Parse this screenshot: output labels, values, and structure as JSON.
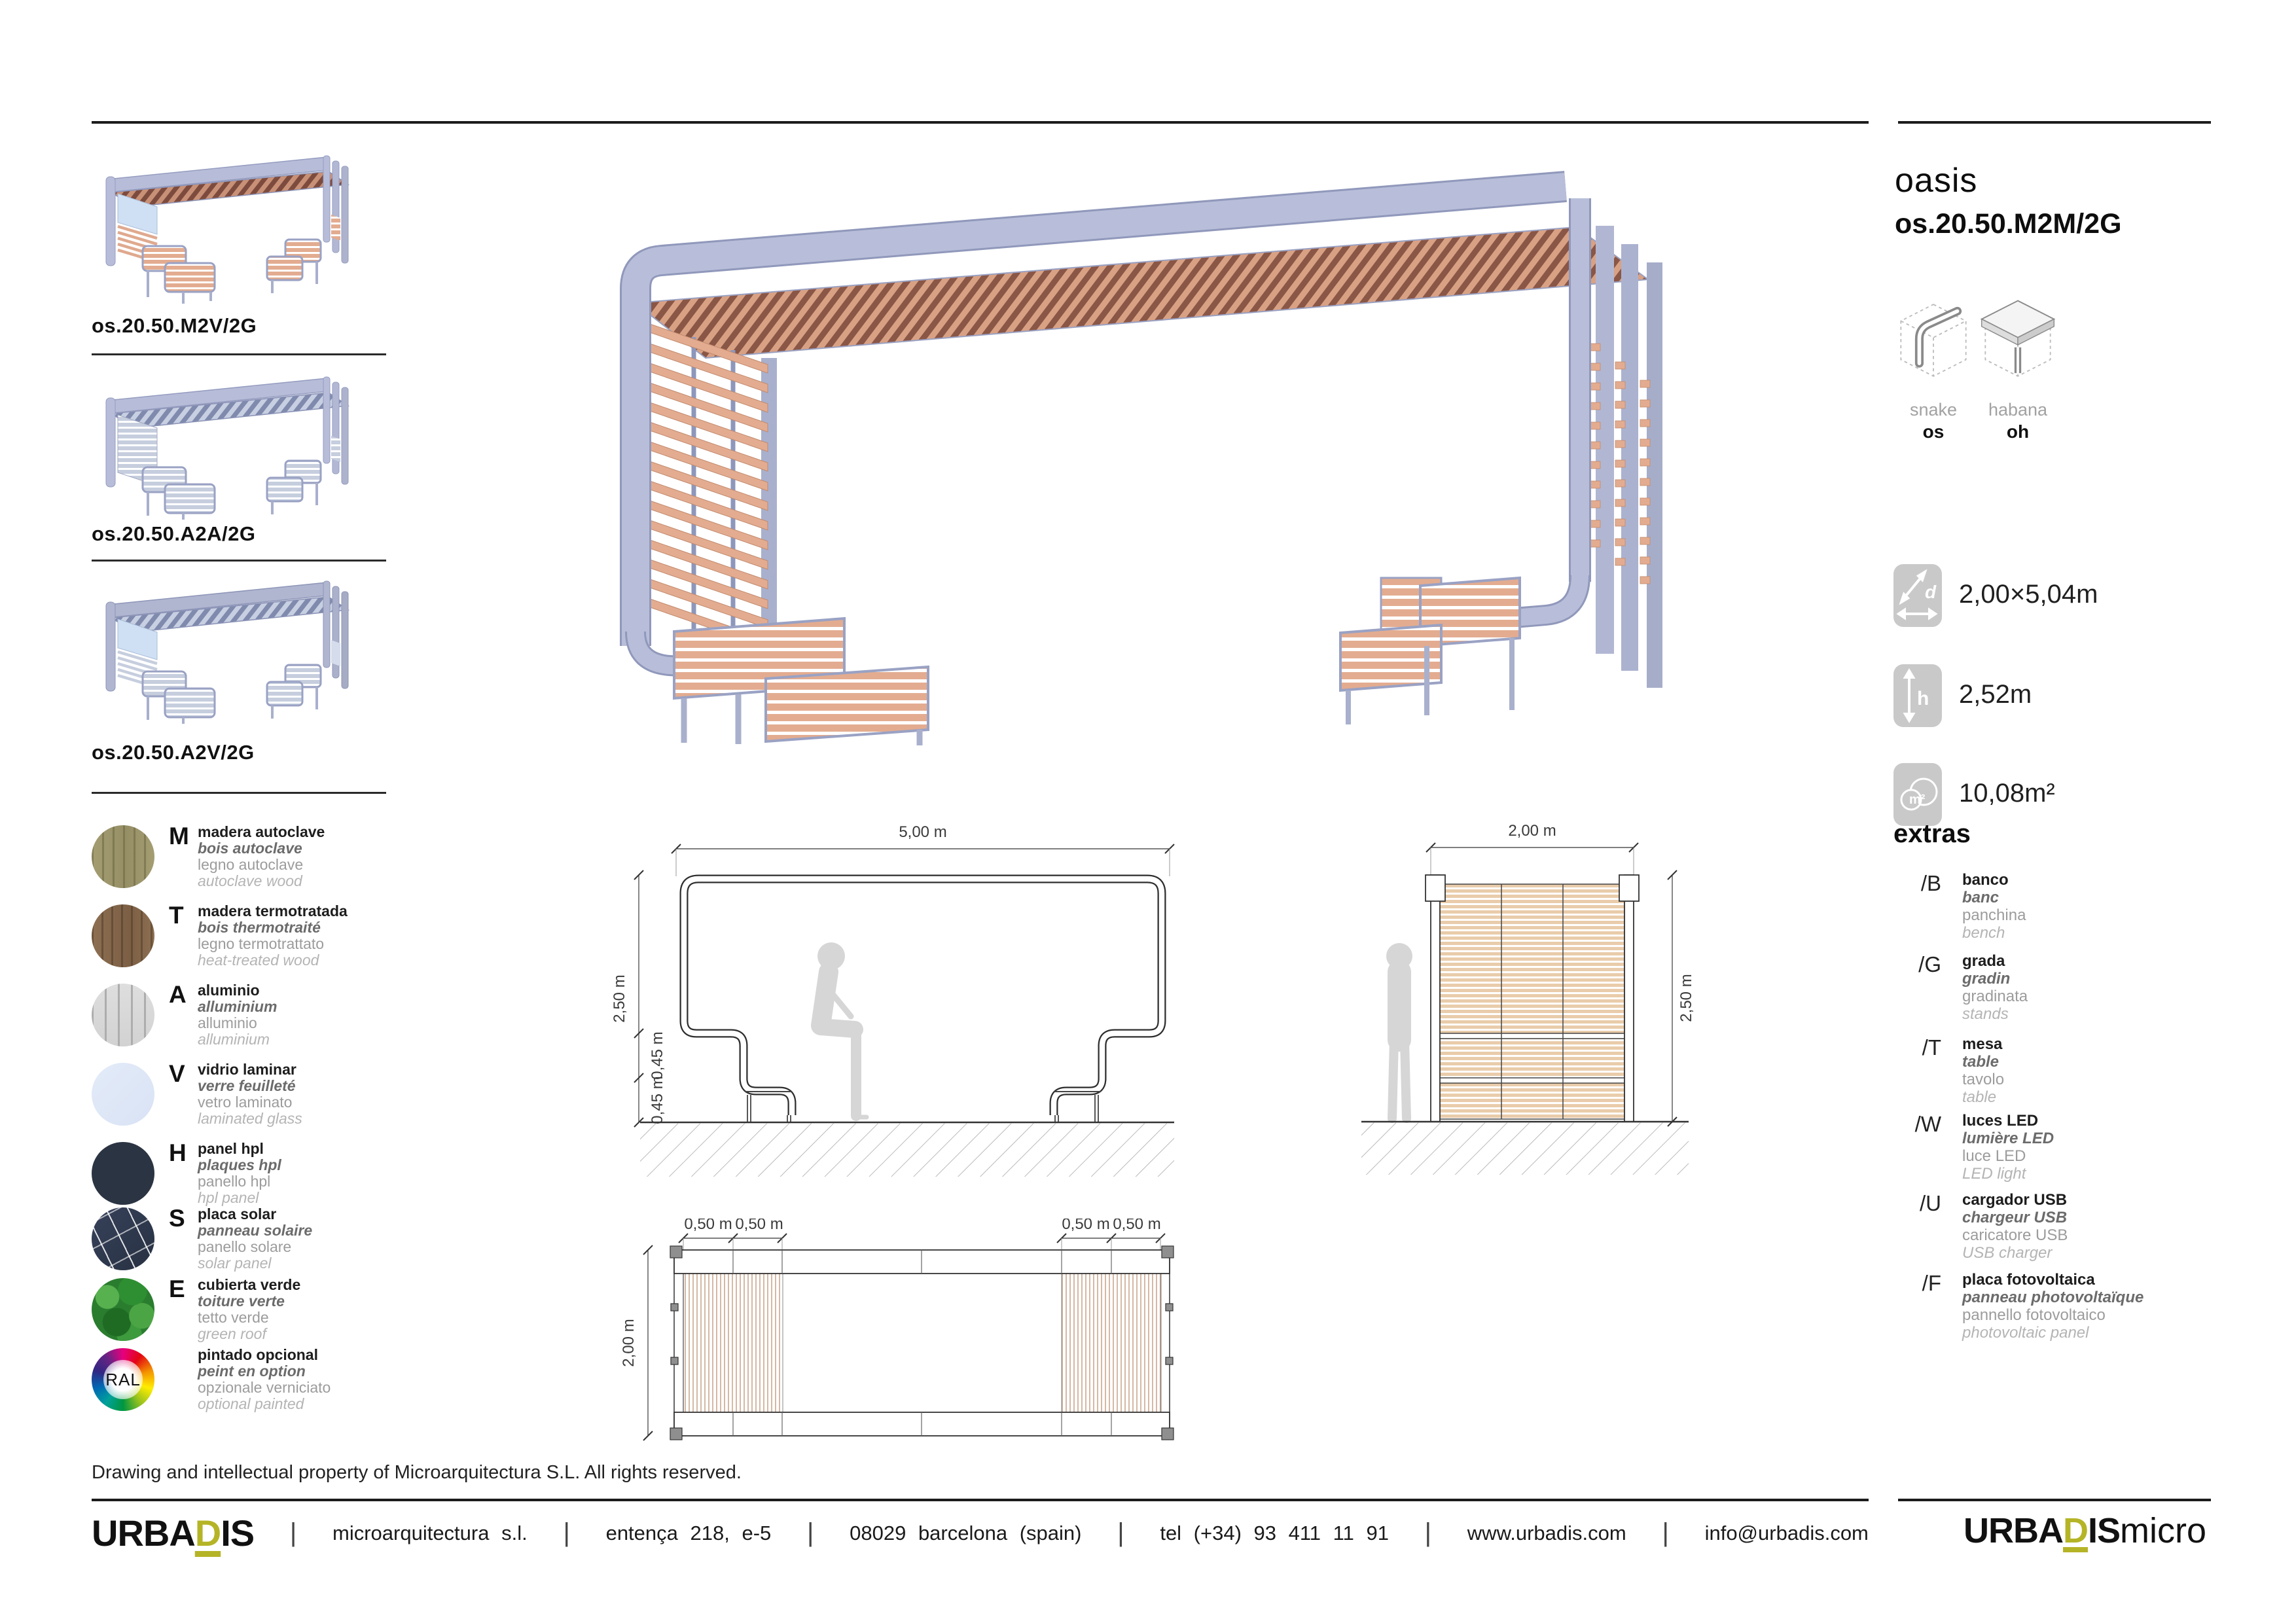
{
  "header": {
    "title": "oasis",
    "model": "os.20.50.M2M/2G",
    "families": [
      {
        "name": "snake",
        "code": "os"
      },
      {
        "name": "habana",
        "code": "oh"
      }
    ]
  },
  "specs": [
    {
      "name": "footprint",
      "value": "2,00×5,04m"
    },
    {
      "name": "height",
      "value": "2,52m"
    },
    {
      "name": "area",
      "value": "10,08m²"
    }
  ],
  "variants": [
    {
      "code": "os.20.50.M2V/2G"
    },
    {
      "code": "os.20.50.A2A/2G"
    },
    {
      "code": "os.20.50.A2V/2G"
    }
  ],
  "materials": {
    "ral_label": "RAL",
    "items": [
      {
        "letter": "M",
        "lines": [
          "madera autoclave",
          "bois autoclave",
          "legno autoclave",
          "autoclave wood"
        ]
      },
      {
        "letter": "T",
        "lines": [
          "madera termotratada",
          "bois thermotraité",
          "legno termotrattato",
          "heat-treated wood"
        ]
      },
      {
        "letter": "A",
        "lines": [
          "aluminio",
          "alluminium",
          "alluminio",
          "alluminium"
        ]
      },
      {
        "letter": "V",
        "lines": [
          "vidrio laminar",
          "verre feuilleté",
          "vetro laminato",
          "laminated glass"
        ]
      },
      {
        "letter": "H",
        "lines": [
          "panel hpl",
          "plaques hpl",
          "panello hpl",
          "hpl panel"
        ]
      },
      {
        "letter": "S",
        "lines": [
          "placa solar",
          "panneau solaire",
          "panello solare",
          "solar panel"
        ]
      },
      {
        "letter": "E",
        "lines": [
          "cubierta verde",
          "toiture verte",
          "tetto verde",
          "green roof"
        ]
      },
      {
        "letter": "",
        "lines": [
          "pintado opcional",
          "peint en option",
          "opzionale verniciato",
          "optional painted"
        ]
      }
    ]
  },
  "extras": {
    "heading": "extras",
    "items": [
      {
        "code": "/B",
        "lines": [
          "banco",
          "banc",
          "panchina",
          "bench"
        ]
      },
      {
        "code": "/G",
        "lines": [
          "grada",
          "gradin",
          "gradinata",
          "stands"
        ]
      },
      {
        "code": "/T",
        "lines": [
          "mesa",
          "table",
          "tavolo",
          "table"
        ]
      },
      {
        "code": "/W",
        "lines": [
          "luces LED",
          "lumière LED",
          "luce LED",
          "LED light"
        ]
      },
      {
        "code": "/U",
        "lines": [
          "cargador USB",
          "chargeur USB",
          "caricatore USB",
          "USB charger"
        ]
      },
      {
        "code": "/F",
        "lines": [
          "placa fotovoltaica",
          "panneau photovoltaïque",
          "pannello fotovoltaico",
          "photovoltaic panel"
        ]
      }
    ]
  },
  "drawings": {
    "front": {
      "width": "5,00 m",
      "height": "2,50 m",
      "step1": "0,45 m",
      "step2": "0,45 m"
    },
    "side": {
      "width": "2,00 m",
      "height": "2,50 m"
    },
    "plan": {
      "depth": "2,00 m",
      "mod1": "0,50 m",
      "mod2": "0,50 m",
      "mod3": "0,50 m",
      "mod4": "0,50 m"
    }
  },
  "footer": {
    "copyright": "Drawing and intellectual property of Microarquitectura S.L. All rights reserved.",
    "brand": {
      "pre": "URBA",
      "d": "D",
      "post": "IS"
    },
    "items": [
      "microarquitectura s.l.",
      "entença 218, e-5",
      "08029 barcelona (spain)",
      "tel (+34) 93 411 11 91",
      "www.urbadis.com",
      "info@urbadis.com"
    ],
    "micro": {
      "pre": "URBA",
      "d": "D",
      "post": "IS",
      "tail": "micro"
    }
  }
}
